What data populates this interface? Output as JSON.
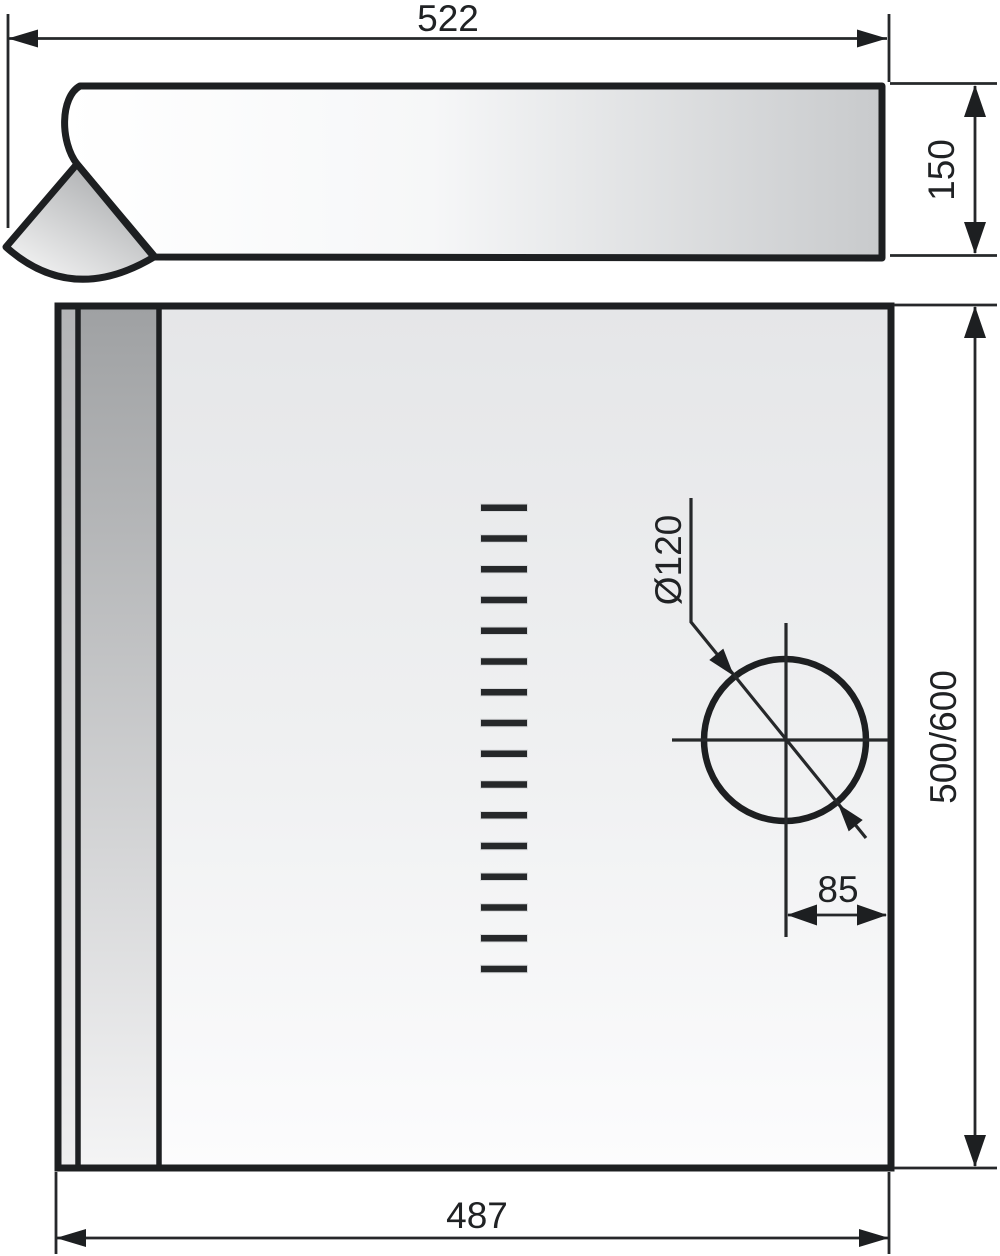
{
  "drawing": {
    "dims": {
      "top_width": "522",
      "side_height": "150",
      "hole_diameter": "Ø120",
      "mount_height": "500/600",
      "hole_offset": "85",
      "bottom_width": "487"
    },
    "vents": {
      "count": 16
    },
    "colors": {
      "ink": "#1d1f21",
      "text": "#202224",
      "panel_shade_dark": "#9fa1a3",
      "panel_shade_light": "#e5e6e8"
    }
  }
}
